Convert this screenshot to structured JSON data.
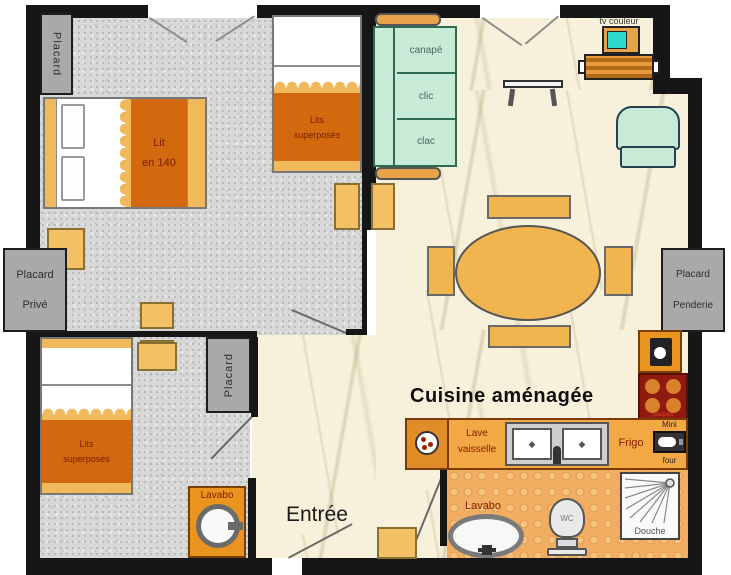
{
  "plan_type": "apartment-floor-plan",
  "colors": {
    "wall": "#161616",
    "bedroom_floor_gray": "#d8d8d8",
    "living_floor_cream": "#f7f0da",
    "bathroom_floor_orange": "#f1ae62",
    "closet_gray": "#a9a9a9",
    "furniture_amber": "#f3c066",
    "blanket_orange": "#d2690e",
    "sofa_mint": "#c7ebd7",
    "counter_orange": "#f2a845",
    "stove_dark_red": "#8e1a10",
    "tv_screen_cyan": "#2bd8cc",
    "furniture_label_red": "#8a2000"
  },
  "bedroom1": {
    "closet_label": "Placard",
    "bed_line1": "Lit",
    "bed_line2": "en 140",
    "bunk_line1": "Lits",
    "bunk_line2": "superposés"
  },
  "bedroom2": {
    "bunk_line1": "Lits",
    "bunk_line2": "superposés",
    "closet_label": "Placard",
    "sink_label": "Lavabo"
  },
  "closets": {
    "private_line1": "Placard",
    "private_line2": "Privé",
    "wardrobe_line1": "Placard",
    "wardrobe_line2": "Penderie"
  },
  "living_room": {
    "sofa_line1": "canapé",
    "sofa_line2": "clic",
    "sofa_line3": "clac",
    "tv_label": "tv couleur"
  },
  "kitchen": {
    "title": "Cuisine aménagée",
    "dishwasher_line1": "Lave",
    "dishwasher_line2": "vaisselle",
    "fridge_label": "Frigo",
    "mini_oven_line1": "Mini",
    "mini_oven_line2": "four",
    "stove_caption": "plaques"
  },
  "entrance": {
    "label": "Entrée"
  },
  "bathroom": {
    "sink_label": "Lavabo",
    "wc_label": "WC",
    "shower_label": "Douche"
  }
}
